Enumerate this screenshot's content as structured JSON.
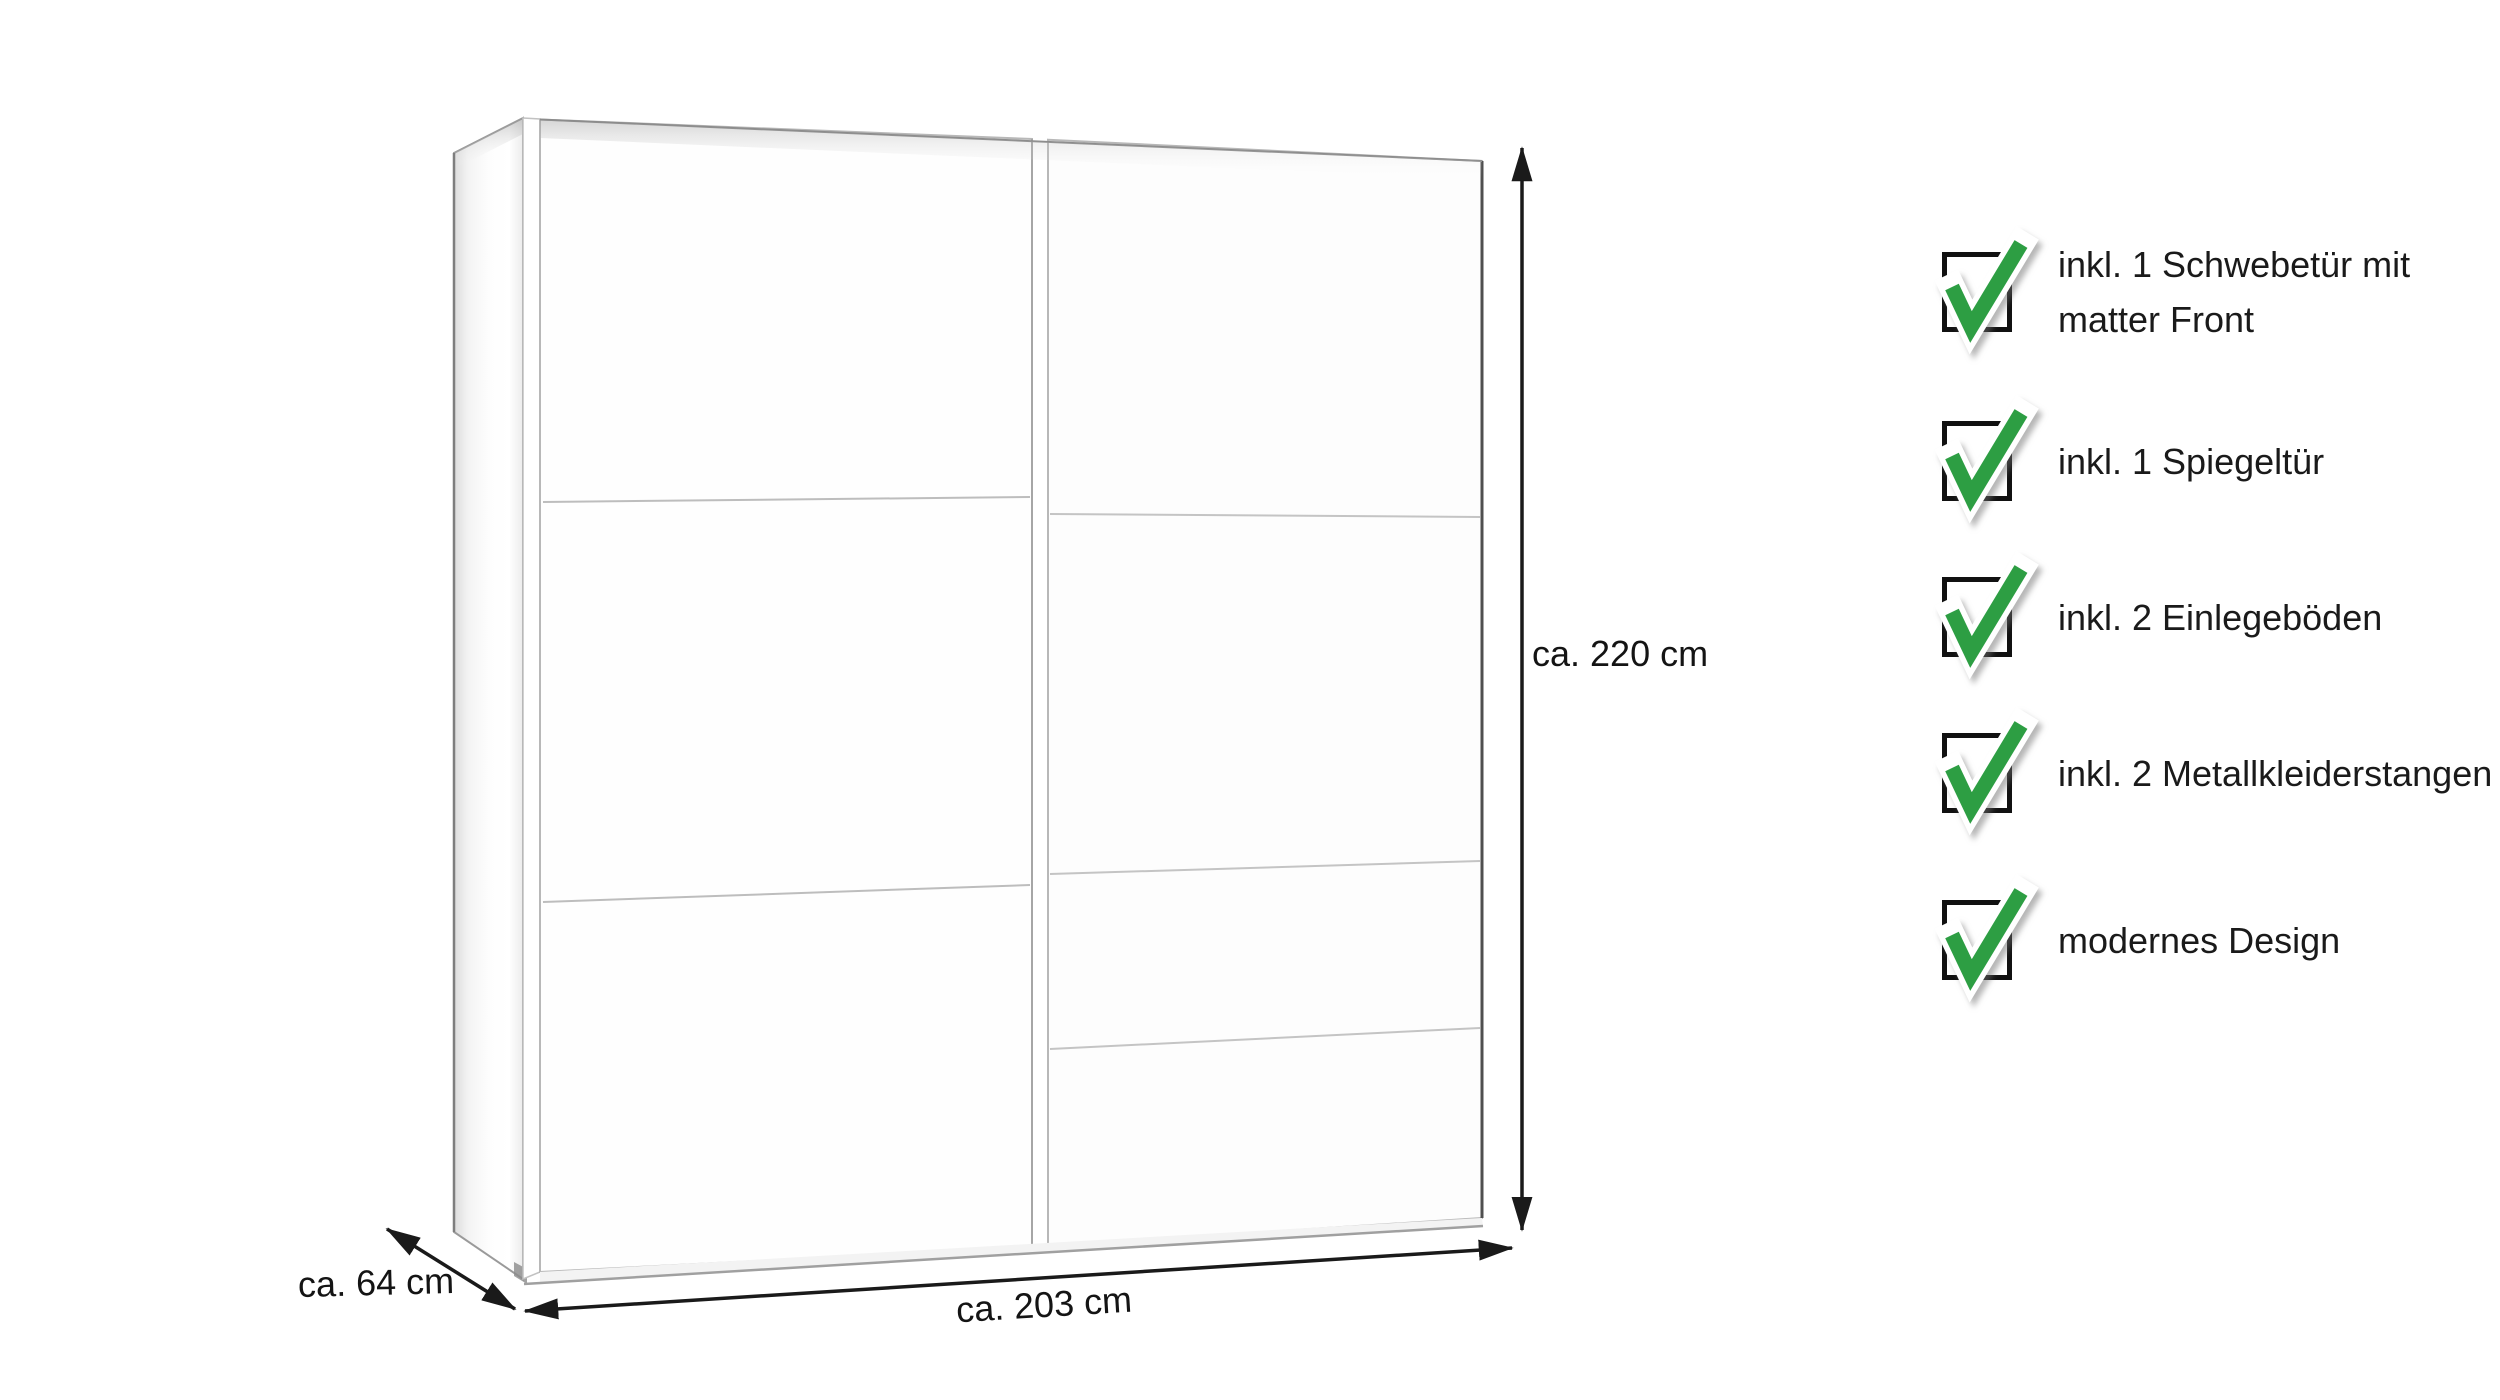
{
  "diagram": {
    "dimension_labels": {
      "height": "ca. 220 cm",
      "width": "ca. 203 cm",
      "depth": "ca. 64 cm"
    }
  },
  "features": {
    "items": [
      {
        "label": "inkl. 1 Schwebetür mit matter Front"
      },
      {
        "label": "inkl. 1 Spiegeltür"
      },
      {
        "label": "inkl. 2 Einlegeböden"
      },
      {
        "label": "inkl. 2 Metallkleiderstangen"
      },
      {
        "label": "modernes Design"
      }
    ],
    "check_color": "#2d9e43",
    "checkbox_border_color": "#111111",
    "text_color": "#1a1a1a"
  }
}
